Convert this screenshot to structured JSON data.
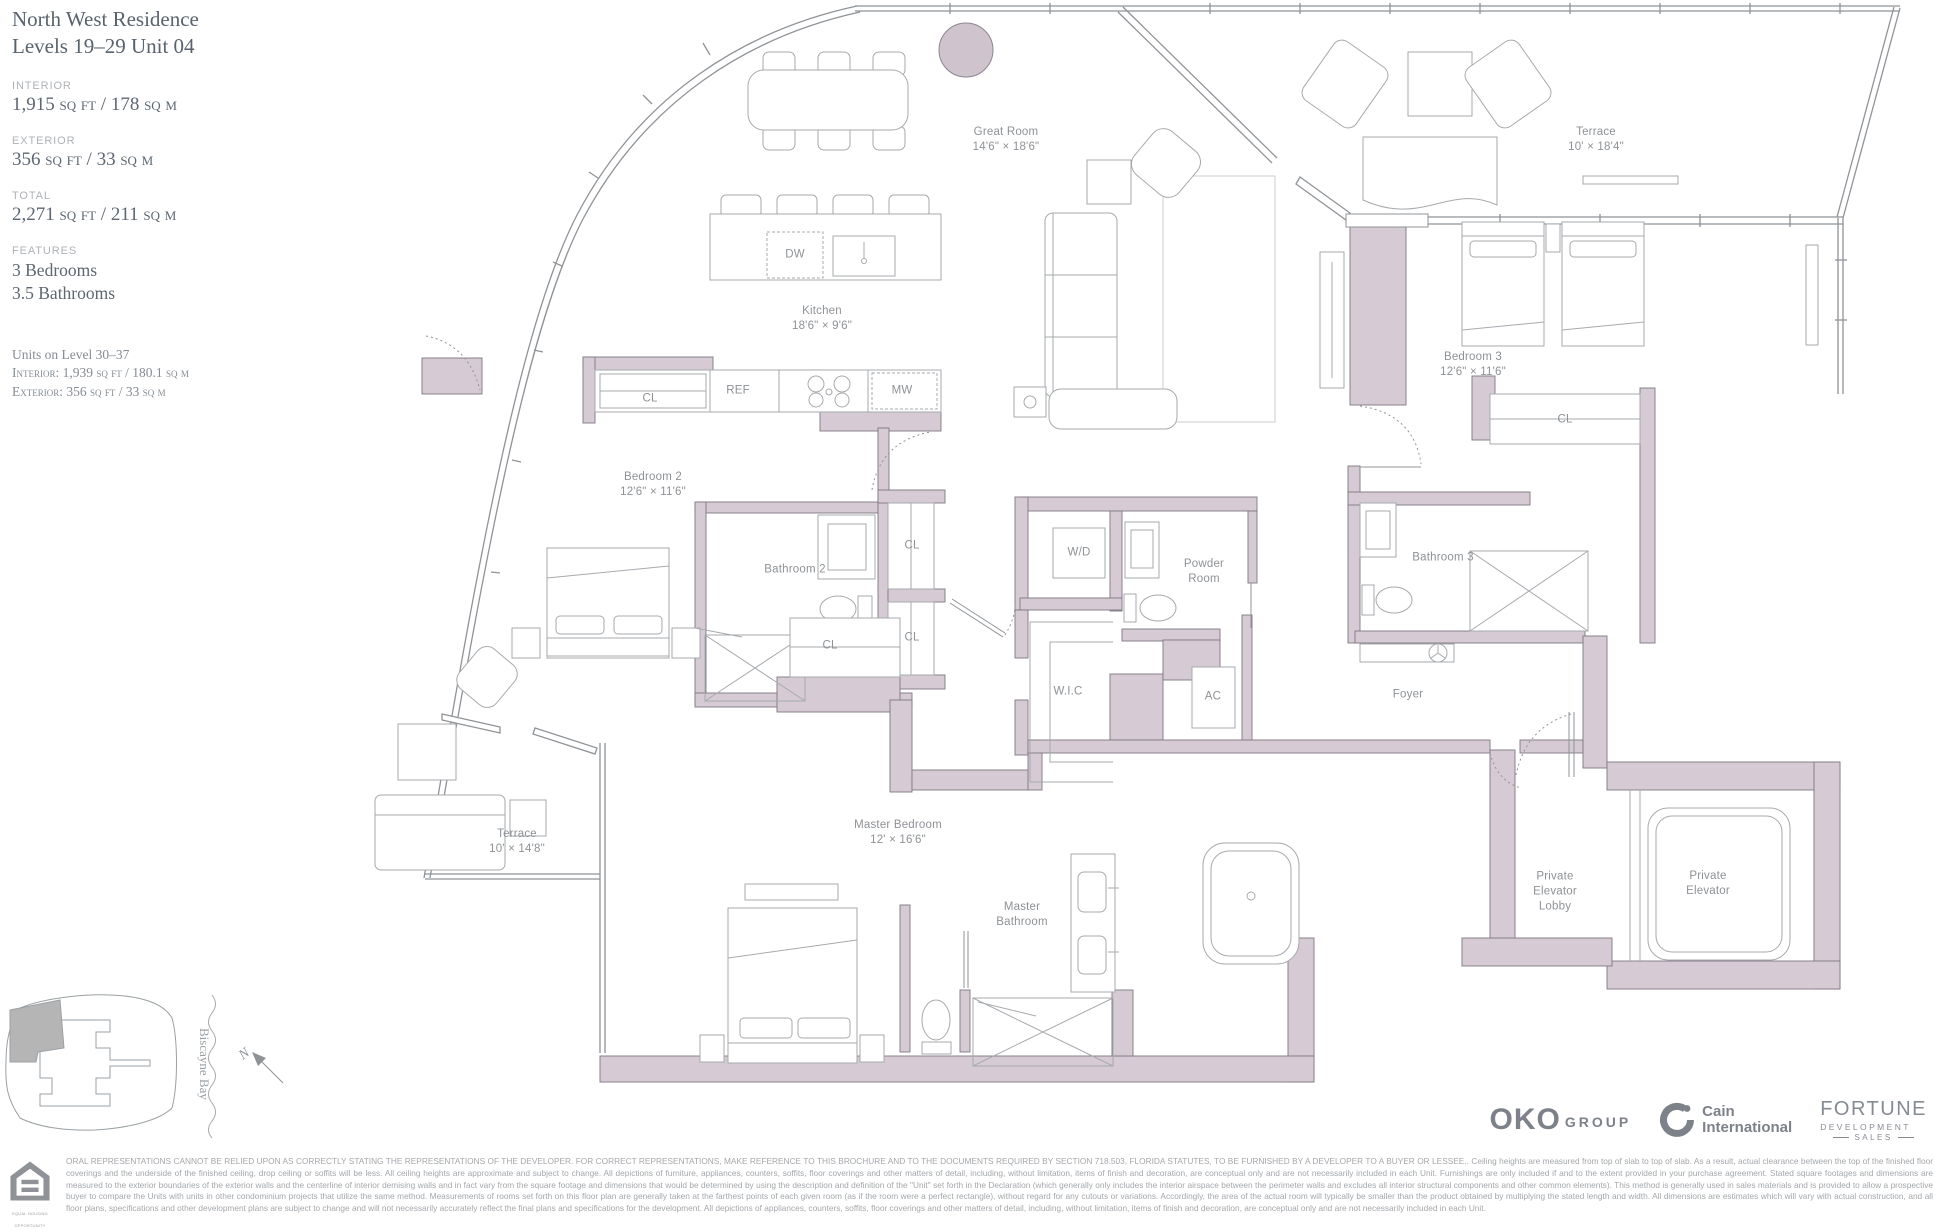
{
  "titleblock": {
    "title_line1": "North West Residence",
    "title_line2": "Levels 19–29 Unit 04",
    "stats": [
      {
        "label": "INTERIOR",
        "value": "1,915 sq ft / 178 sq m"
      },
      {
        "label": "EXTERIOR",
        "value": "356 sq ft / 33 sq m"
      },
      {
        "label": "TOTAL",
        "value": "2,271 sq ft / 211 sq m"
      }
    ],
    "features_label": "FEATURES",
    "features": [
      "3 Bedrooms",
      "3.5 Bathrooms"
    ],
    "alt_units_title": "Units on Level 30–37",
    "alt_units_interior": "Interior: 1,939 sq ft / 180.1 sq m",
    "alt_units_exterior": "Exterior: 356 sq ft / 33 sq m"
  },
  "plan": {
    "wall_color": "#d6cbd4",
    "rooms": [
      {
        "name": "Great Room",
        "dims": "14'6\" × 18'6\""
      },
      {
        "name": "Kitchen",
        "dims": "18'6\" × 9'6\""
      },
      {
        "name": "Terrace",
        "dims": "10' × 18'4\""
      },
      {
        "name": "Bedroom 3",
        "dims": "12'6\" × 11'6\""
      },
      {
        "name": "Bedroom 2",
        "dims": "12'6\" × 11'6\""
      },
      {
        "name": "Bathroom 2"
      },
      {
        "name": "Bathroom 3"
      },
      {
        "name": "Powder\nRoom"
      },
      {
        "name": "W/D"
      },
      {
        "name": "W.I.C"
      },
      {
        "name": "AC"
      },
      {
        "name": "Foyer"
      },
      {
        "name": "Master Bedroom",
        "dims": "12' × 16'6\""
      },
      {
        "name": "Master\nBathroom"
      },
      {
        "name": "Terrace",
        "dims": "10' × 14'8\""
      },
      {
        "name": "Private\nElevator\nLobby"
      },
      {
        "name": "Private\nElevator"
      }
    ],
    "small_labels": [
      {
        "t": "DW"
      },
      {
        "t": "REF"
      },
      {
        "t": "MW"
      },
      {
        "t": "CL"
      },
      {
        "t": "CL"
      },
      {
        "t": "CL"
      },
      {
        "t": "CL"
      },
      {
        "t": "CL"
      }
    ]
  },
  "keyplan": {
    "bay_label": "Biscayne Bay",
    "north_label": "N"
  },
  "footer": {
    "logos": {
      "oko_bold": "OKO",
      "oko_light": "GROUP",
      "cain_line1": "Cain",
      "cain_line2": "International",
      "fortune_line1": "FORTUNE",
      "fortune_line2": "DEVELOPMENT",
      "fortune_line3": "SALES"
    },
    "eho_caption": "EQUAL HOUSING OPPORTUNITY",
    "disclaimer_caps": "ORAL REPRESENTATIONS CANNOT BE RELIED UPON AS CORRECTLY STATING THE REPRESENTATIONS OF THE DEVELOPER. FOR CORRECT REPRESENTATIONS, MAKE REFERENCE TO THIS BROCHURE AND TO THE DOCUMENTS REQUIRED BY SECTION 718.503, FLORIDA STATUTES, TO BE FURNISHED BY A DEVELOPER TO A BUYER OR LESSEE..",
    "disclaimer_body": "Ceiling heights are measured from top of slab to top of slab. As a result, actual clearance between the top of the finished floor coverings and the underside of the finished ceiling, drop ceiling or soffits will be less. All ceiling heights are approximate and subject to change. All depictions of furniture, appliances, counters, soffits, floor coverings and other matters of detail, including, without limitation, items of finish and decoration, are conceptual only and are not necessarily included in each Unit. Furnishings are only included if and to the extent provided in your purchase agreement. Stated square footages and dimensions are measured to the exterior boundaries of the exterior walls and the centerline of interior demising walls and in fact vary from the square footage and dimensions that would be determined by using the description and definition of the \"Unit\" set forth in the Declaration (which generally only includes the interior airspace between the perimeter walls and excludes all interior structural components and other common elements). This method is generally used in sales materials and is provided to allow a prospective buyer to compare the Units with units in other condominium projects that utilize the same method. Measurements of rooms set forth on this floor plan are generally taken at the farthest points of each given room (as if the room were a perfect rectangle), without regard for any cutouts or variations. Accordingly, the area of the actual room will typically be smaller than the product obtained by multiplying the stated length and width. All dimensions are estimates which will vary with actual construction, and all floor plans, specifications and other development plans are subject to change and will not necessarily accurately reflect the final plans and specifications for the development. All depictions of appliances, counters, soffits, floor coverings and other matters of detail, including, without limitation, items of finish and decoration, are conceptual only and are not necessarily included in each Unit."
  }
}
